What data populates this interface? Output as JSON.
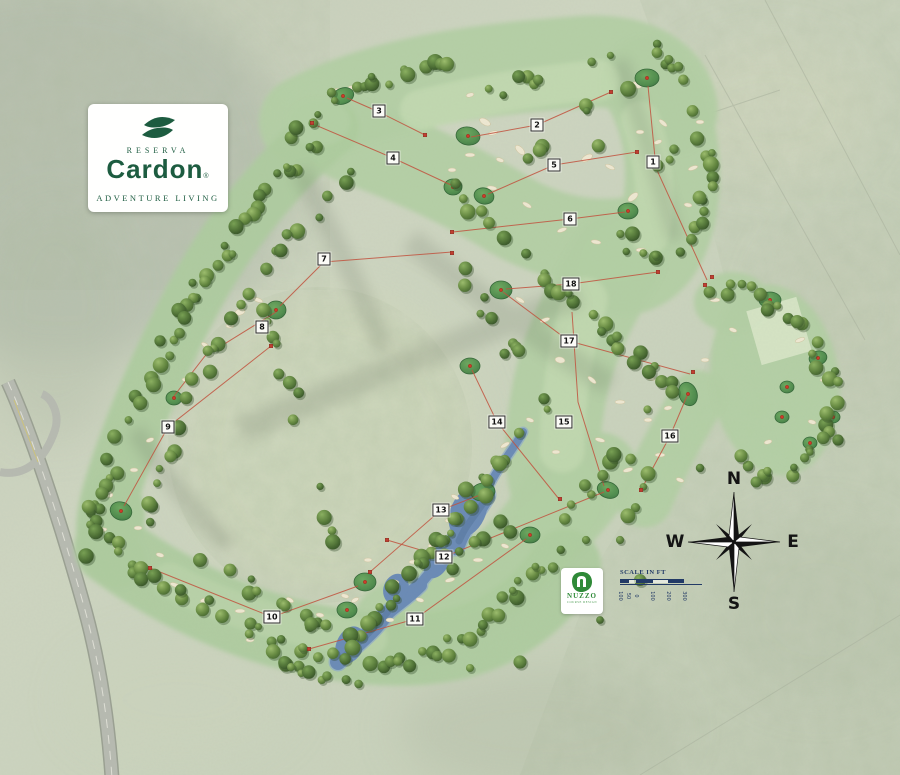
{
  "title": "Reserva Cardon golf course master plan",
  "branding": {
    "reserva": "RESERVA",
    "name": "Cardon",
    "registered": "®",
    "tagline": "ADVENTURE LIVING",
    "color": "#1d5c40"
  },
  "designer": {
    "name": "NUZZO",
    "tagline": "COURSE DESIGN",
    "color": "#2f8a38"
  },
  "compass": {
    "n": "N",
    "s": "S",
    "e": "E",
    "w": "W"
  },
  "scale_bar": {
    "title": "SCALE IN FT",
    "labels": [
      "100",
      "50",
      "0",
      "100",
      "200",
      "300"
    ],
    "label_positions_px": [
      0,
      8,
      16,
      32,
      48,
      64
    ],
    "color": "#223a66"
  },
  "holes": [
    {
      "number": "1",
      "label_x": 653,
      "label_y": 162,
      "route": [
        [
          707,
          280
        ],
        [
          656,
          168
        ],
        [
          648,
          86
        ]
      ]
    },
    {
      "number": "2",
      "label_x": 537,
      "label_y": 125,
      "route": [
        [
          611,
          92
        ],
        [
          537,
          125
        ],
        [
          471,
          137
        ]
      ]
    },
    {
      "number": "3",
      "label_x": 379,
      "label_y": 111,
      "route": [
        [
          427,
          136
        ],
        [
          379,
          112
        ],
        [
          347,
          98
        ]
      ]
    },
    {
      "number": "4",
      "label_x": 393,
      "label_y": 158,
      "route": [
        [
          313,
          124
        ],
        [
          393,
          158
        ],
        [
          451,
          185
        ]
      ]
    },
    {
      "number": "5",
      "label_x": 554,
      "label_y": 165,
      "route": [
        [
          637,
          152
        ],
        [
          554,
          165
        ],
        [
          488,
          194
        ]
      ]
    },
    {
      "number": "6",
      "label_x": 570,
      "label_y": 219,
      "route": [
        [
          453,
          232
        ],
        [
          570,
          219
        ],
        [
          625,
          212
        ]
      ]
    },
    {
      "number": "7",
      "label_x": 324,
      "label_y": 259,
      "route": [
        [
          452,
          252
        ],
        [
          324,
          262
        ],
        [
          280,
          306
        ]
      ]
    },
    {
      "number": "8",
      "label_x": 262,
      "label_y": 327,
      "route": [
        [
          276,
          312
        ],
        [
          205,
          356
        ],
        [
          174,
          396
        ]
      ]
    },
    {
      "number": "9",
      "label_x": 168,
      "label_y": 427,
      "route": [
        [
          271,
          346
        ],
        [
          168,
          427
        ],
        [
          124,
          506
        ]
      ]
    },
    {
      "number": "10",
      "label_x": 272,
      "label_y": 617,
      "route": [
        [
          150,
          568
        ],
        [
          272,
          617
        ],
        [
          358,
          586
        ]
      ]
    },
    {
      "number": "11",
      "label_x": 415,
      "label_y": 619,
      "route": [
        [
          309,
          649
        ],
        [
          415,
          619
        ],
        [
          526,
          539
        ]
      ]
    },
    {
      "number": "12",
      "label_x": 444,
      "label_y": 557,
      "route": [
        [
          387,
          540
        ],
        [
          444,
          557
        ],
        [
          604,
          492
        ]
      ]
    },
    {
      "number": "13",
      "label_x": 441,
      "label_y": 510,
      "route": [
        [
          370,
          572
        ],
        [
          441,
          510
        ],
        [
          480,
          495
        ]
      ]
    },
    {
      "number": "14",
      "label_x": 497,
      "label_y": 422,
      "route": [
        [
          559,
          499
        ],
        [
          497,
          422
        ],
        [
          472,
          370
        ]
      ]
    },
    {
      "number": "15",
      "label_x": 564,
      "label_y": 422,
      "route": [
        [
          572,
          312
        ],
        [
          578,
          402
        ],
        [
          604,
          486
        ]
      ]
    },
    {
      "number": "16",
      "label_x": 670,
      "label_y": 436,
      "route": [
        [
          641,
          490
        ],
        [
          670,
          436
        ],
        [
          687,
          396
        ]
      ]
    },
    {
      "number": "17",
      "label_x": 569,
      "label_y": 341,
      "route": [
        [
          503,
          292
        ],
        [
          569,
          341
        ],
        [
          690,
          374
        ]
      ]
    },
    {
      "number": "18",
      "label_x": 571,
      "label_y": 284,
      "route": [
        [
          658,
          272
        ],
        [
          571,
          284
        ],
        [
          506,
          289
        ]
      ]
    }
  ],
  "colors": {
    "route_red": "#c2503c",
    "fairway_green": "#b3cfa4",
    "putting_green": "#4c8a4a",
    "water_blue": "#6a8ab6",
    "tree_green": "#4c6e34",
    "bunker_sand": "#efe8d2",
    "brand_green": "#1d5c40",
    "scale_navy": "#223a66"
  }
}
